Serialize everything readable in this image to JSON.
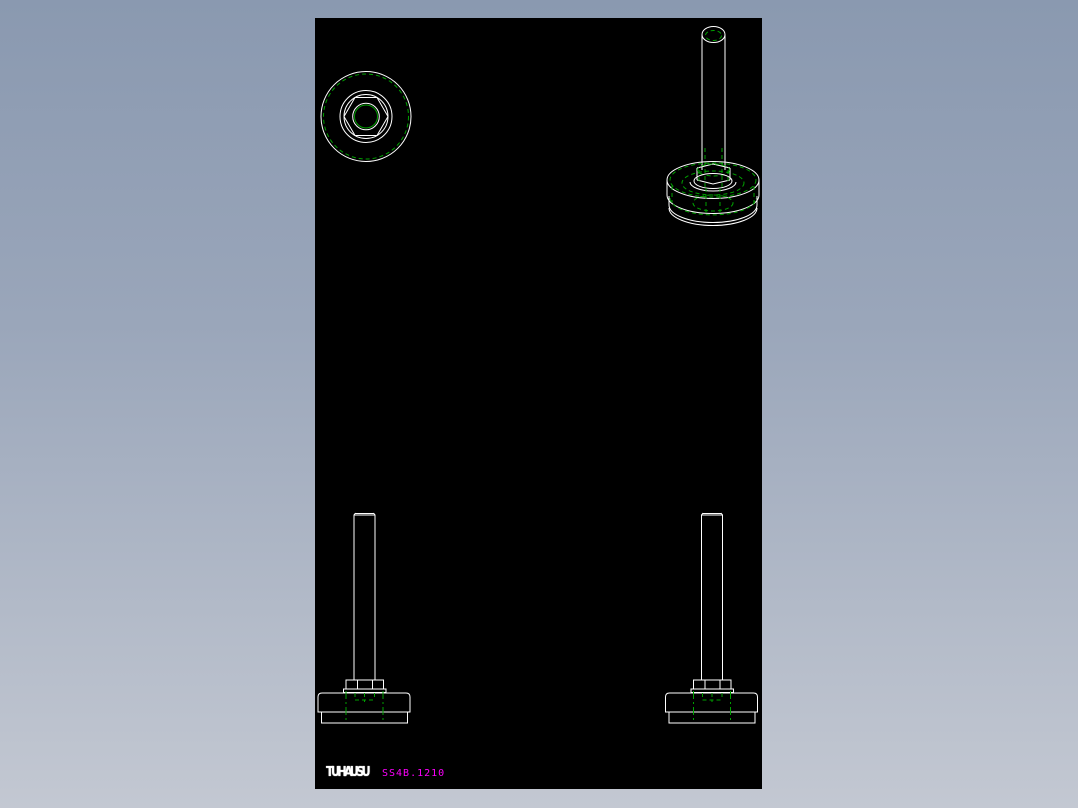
{
  "window": {
    "background_gradient_top": "#8a99b0",
    "background_gradient_bottom": "#c3c8d2"
  },
  "canvas": {
    "background_color": "#000000",
    "visible_line_color": "#ffffff",
    "hidden_line_color": "#00a000",
    "views": {
      "top_view": "plan view of adjustable leveling foot (concentric circles with hex nut)",
      "isometric_view": "isometric view of leveling foot with threaded stem",
      "front_view_left": "front elevation of leveling foot",
      "front_view_right": "front elevation of leveling foot"
    }
  },
  "watermark": {
    "logo_text": "TUHAUSU",
    "logo_color": "#ffffff",
    "part_number": "SS4B.1210",
    "part_number_color": "#ff00ff"
  }
}
